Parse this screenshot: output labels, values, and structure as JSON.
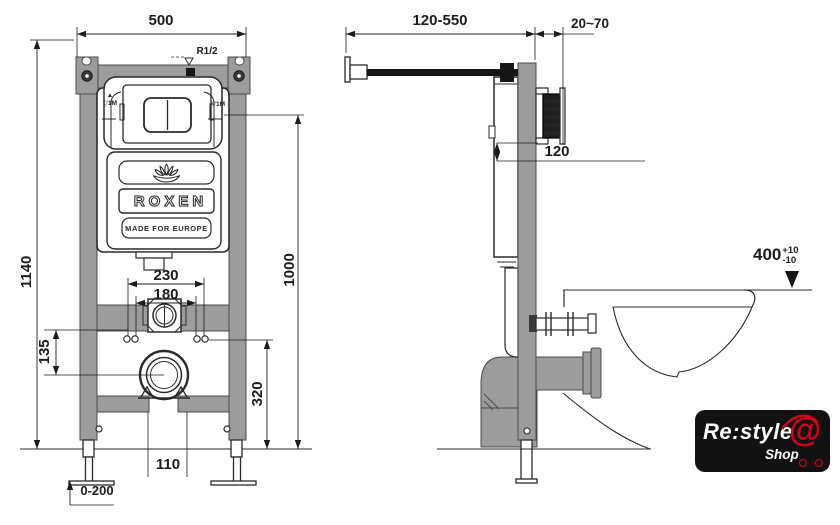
{
  "front_view": {
    "dims": {
      "overall_width": "500",
      "overall_height": "1140",
      "water_level_height": "1000",
      "outlet_offset": "320",
      "bracket_spacing": "135",
      "fixing_outer": "230",
      "fixing_inner": "180",
      "drain_gap": "110",
      "leg_adjust": "0-200"
    },
    "labels": {
      "water_inlet": "R1/2",
      "level_arrow": "▲",
      "level_mark": "▽1M"
    },
    "logo": {
      "brand": "ROXEN",
      "tagline": "MADE FOR EUROPE"
    }
  },
  "side_view": {
    "dims": {
      "arm_depth_range": "120-550",
      "wall_finish_range": "20~70",
      "plate_depth": "120",
      "bowl_height": "400",
      "bowl_height_tol_plus": "+10",
      "bowl_height_tol_minus": "-10"
    }
  },
  "watermark": {
    "brand_main": "Re:style",
    "brand_sub": "Shop",
    "at_symbol": "@"
  },
  "colors": {
    "line": "#2a2a2a",
    "frame_gray": "#9c9c9c",
    "dark_fill": "#161616",
    "logo_bg": "#121212",
    "logo_red": "#d6001c",
    "background": "#ffffff"
  }
}
